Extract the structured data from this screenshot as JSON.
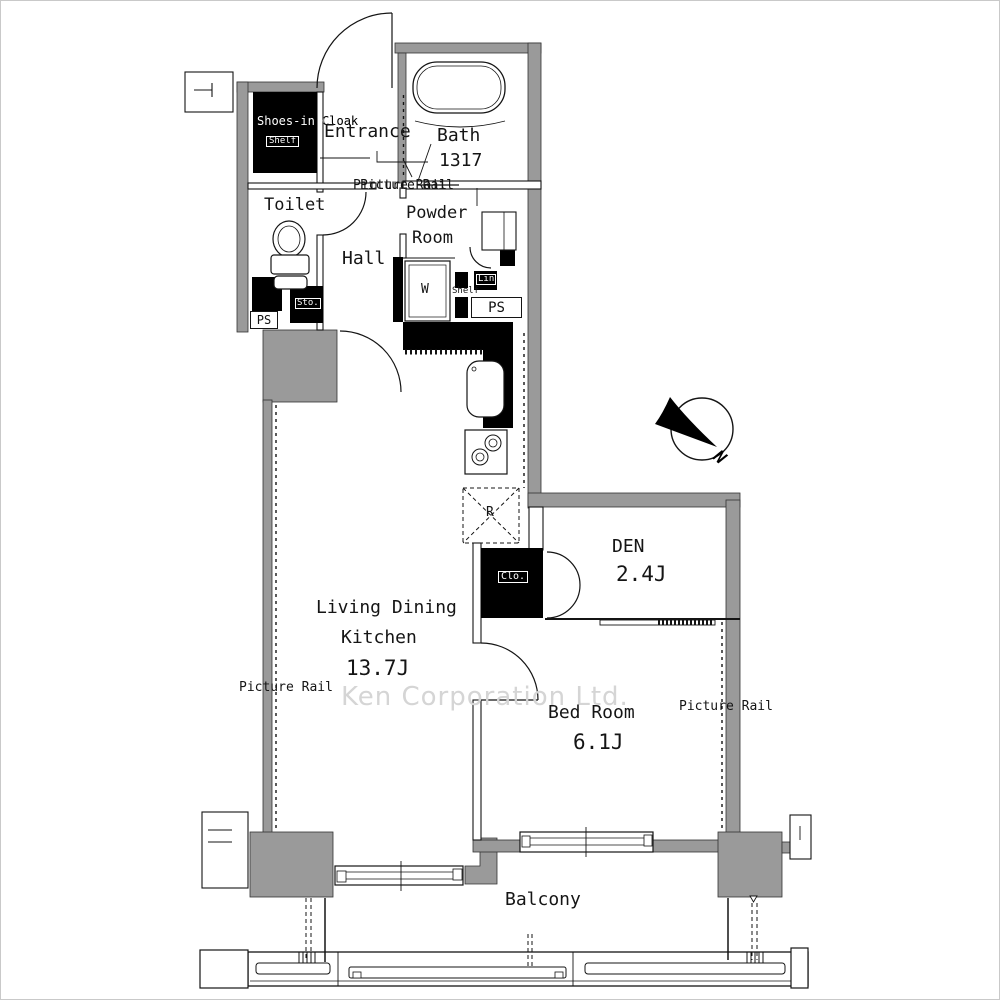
{
  "colors": {
    "wall_gray": "#9a9a9a",
    "line_black": "#141414",
    "watermark_gray": "#d5d5d5"
  },
  "rooms": {
    "shoes_in_cloak": {
      "label": "Shoes-in Cloak",
      "shelf": "Shelf"
    },
    "entrance": {
      "label": "Entrance"
    },
    "bath": {
      "label": "Bath",
      "size": "1317"
    },
    "toilet": {
      "label": "Toilet"
    },
    "powder_room": {
      "line1": "Powder",
      "line2": "Room",
      "washer": "W",
      "linen": "Lin",
      "shelf": "Shelf"
    },
    "hall": {
      "label": "Hall"
    },
    "ldk": {
      "line1": "Living Dining",
      "line2": "Kitchen",
      "size": "13.7J",
      "fridge": "R"
    },
    "den": {
      "label": "DEN",
      "size": "2.4J",
      "closet": "Clo."
    },
    "bedroom": {
      "label": "Bed Room",
      "size": "6.1J"
    },
    "balcony": {
      "label": "Balcony"
    }
  },
  "annotations": {
    "picture_rail_hall": "Picture Rail",
    "picture_rail_left": "Picture Rail",
    "picture_rail_right": "Picture Rail",
    "ps_left": "PS",
    "ps_right": "PS",
    "storage": "Sto.",
    "compass_north": "N",
    "watermark": "Ken Corporation Ltd."
  }
}
